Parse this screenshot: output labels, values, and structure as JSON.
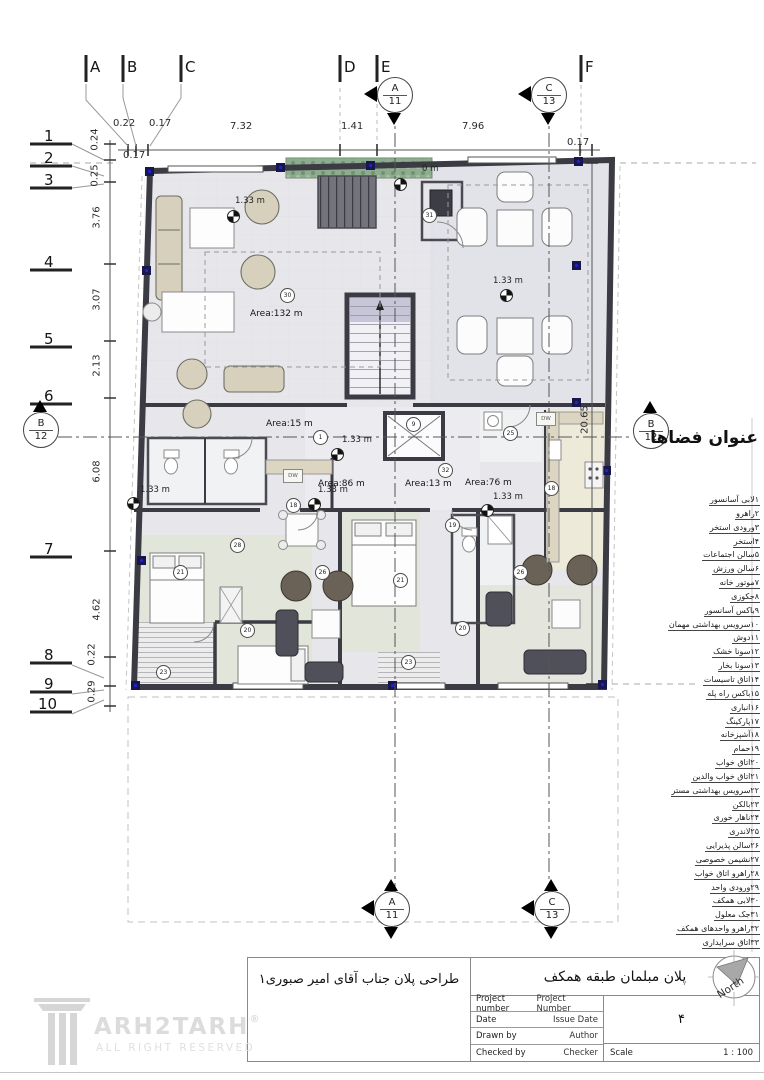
{
  "grid": {
    "cols": [
      "A",
      "B",
      "C",
      "D",
      "E",
      "F"
    ],
    "rows": [
      "1",
      "2",
      "3",
      "4",
      "5",
      "6",
      "7",
      "8",
      "9",
      "10"
    ],
    "top_dims": [
      "0.22",
      "0.17",
      "7.32",
      "1.41",
      "7.96"
    ],
    "edge_dims": [
      "0.17",
      "0.17"
    ],
    "left_dims": [
      "0.24",
      "0.25",
      "3.76",
      "3.07",
      "2.13",
      "6.08",
      "4.62",
      "0.22",
      "0.29"
    ],
    "right_dim": "20.65"
  },
  "section_markers": {
    "a": {
      "letter": "A",
      "number": "11"
    },
    "b": {
      "letter": "B",
      "number": "12"
    },
    "c": {
      "letter": "C",
      "number": "13"
    }
  },
  "plan": {
    "area_labels": {
      "lobby": "Area:132 m",
      "elevator_lobby": "Area:15 m",
      "unit_left": "Area:86 m",
      "corridor": "Area:13 m",
      "unit_right": "Area:76 m"
    },
    "level_labels": {
      "zero": "0 m",
      "half": "1.33 m"
    },
    "appliance_labels": {
      "dishwasher": "DW"
    },
    "markers": [
      "30",
      "31",
      "9",
      "1",
      "32",
      "18",
      "18",
      "19",
      "25",
      "28",
      "21",
      "26",
      "20",
      "23",
      "21",
      "26",
      "20",
      "23"
    ]
  },
  "spaces": {
    "title": "عنوان فضاها",
    "items": [
      "۱لابی آسانسور",
      "۲راهرو",
      "۳ورودی استخر",
      "۴استخر",
      "۵سالن اجتماعات",
      "۶سالن ورزش",
      "۷موتور خانه",
      "۸جکوزی",
      "۹باکس آسانسور",
      "۱۰سرویس بهداشتی مهمان",
      "۱۱دوش",
      "۱۲سونا خشک",
      "۱۳سونا بخار",
      "۱۴اتاق تاسیسات",
      "۱۵باکس راه پله",
      "۱۶انباری",
      "۱۷پارکینگ",
      "۱۸آشپزخانه",
      "۱۹حمام",
      "۲۰اتاق خواب",
      "۲۱اتاق خواب والدین",
      "۲۲سرویس بهداشتی مستر",
      "۲۳بالکن",
      "۲۴ناهار خوری",
      "۲۵لاندری",
      "۲۶سالن پذیرایی",
      "۲۷نشیمن خصوصی",
      "۲۸راهرو اتاق خواب",
      "۲۹ورودی واحد",
      "۳۰لابی همکف",
      "۳۱جک معلول",
      "۳۲راهرو واحدهای همکف",
      "۳۳اتاق سرایداری"
    ]
  },
  "titleblock": {
    "client_title": "طراحی پلان جناب آقای امیر صبوری۱",
    "sheet_title": "پلان مبلمان طبقه همکف",
    "rows": [
      {
        "label": "Project number",
        "value": "Project Number"
      },
      {
        "label": "Date",
        "value": "Issue Date"
      },
      {
        "label": "Drawn by",
        "value": "Author"
      },
      {
        "label": "Checked by",
        "value": "Checker"
      }
    ],
    "sheet_number": "۴",
    "scale_label": "Scale",
    "scale_value": "1 : 100",
    "north_label": "North"
  },
  "logo": {
    "brand": "ARH2TARH",
    "registered": "®",
    "tagline": "ALL RIGHT RESERVED"
  },
  "colors": {
    "wall": "#3b3b43",
    "column": "#17174e",
    "floor": "#e7e7eb",
    "bedroom_floor": "#e2e5d9",
    "planter": "#8fac90",
    "accent_blue": "#2121d0"
  }
}
